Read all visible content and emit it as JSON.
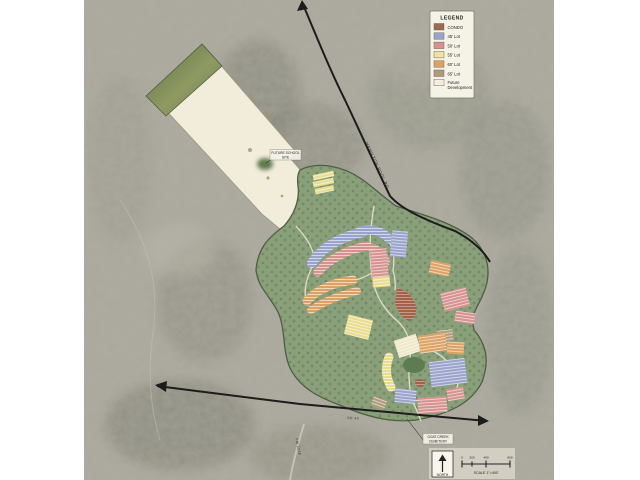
{
  "legend": {
    "title": "LEGEND",
    "items": [
      {
        "label": "CONDO",
        "color": "#9c6b4f"
      },
      {
        "label": "45' Lot",
        "color": "#9aa3cc"
      },
      {
        "label": "50' Lot",
        "color": "#d6928f"
      },
      {
        "label": "55' Lot",
        "color": "#eee3a0"
      },
      {
        "label": "60' Lot",
        "color": "#dda263"
      },
      {
        "label": "65' Lot",
        "color": "#b09a7c"
      },
      {
        "label": "Future Development",
        "line1": "Future",
        "line2": "Development",
        "color": "#f4efda"
      }
    ]
  },
  "road_labels": {
    "highway": "HAMILTON POOL RD",
    "bottom": "SH 45",
    "side": "FM 3238"
  },
  "callouts": {
    "tract": {
      "line1": "FUTURE SCHOOL",
      "line2": "SITE"
    },
    "junction": {
      "line1": "GOAT CREEK",
      "line2": "CEMETERY"
    }
  },
  "compass": {
    "label": "NORTH"
  },
  "scale_bar": {
    "ticks": [
      "0",
      "200",
      "400",
      "800"
    ],
    "label": "SCALE 1\"=400'"
  },
  "colors": {
    "aerial_base": "#aba89c",
    "open_space": "#8aa07b",
    "future_tract": "#f2eddb",
    "road": "#1c1c1c"
  }
}
